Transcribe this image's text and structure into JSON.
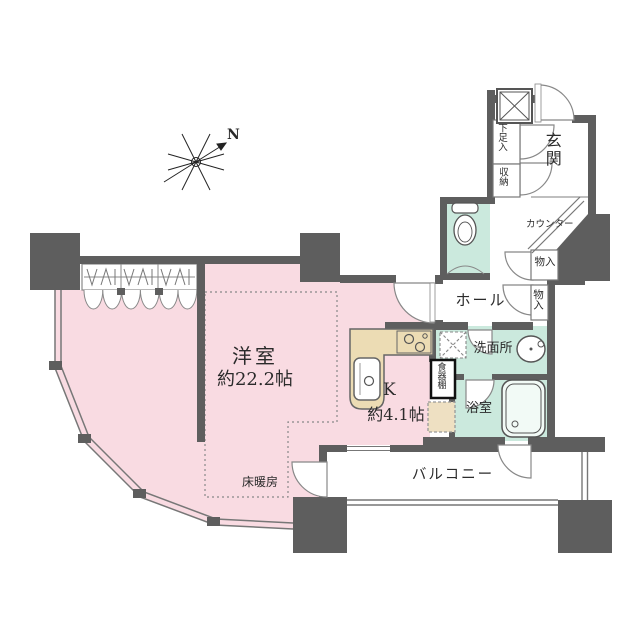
{
  "compass": {
    "label": "N"
  },
  "rooms": {
    "living": {
      "name": "洋室",
      "size": "約22.2帖",
      "floor_heating": "床暖房"
    },
    "kitchen": {
      "name": "K",
      "size": "約4.1帖",
      "cupboard": "食器棚"
    },
    "hall": {
      "name": "ホール",
      "closet1": "物入",
      "closet2": "物入"
    },
    "entrance": {
      "name": "玄関",
      "counter": "カウンター",
      "shoe_cabinet": "下足入",
      "storage": "収納"
    },
    "washroom": {
      "name": "洗面所"
    },
    "bathroom": {
      "name": "浴室"
    },
    "balcony": {
      "name": "バルコニー"
    }
  },
  "colors": {
    "wall": "#5e5e5e",
    "room_pink": "#f9dbe2",
    "wet_teal": "#cbe9dd",
    "counter_beige": "#ecdcb4",
    "line": "#777777"
  }
}
